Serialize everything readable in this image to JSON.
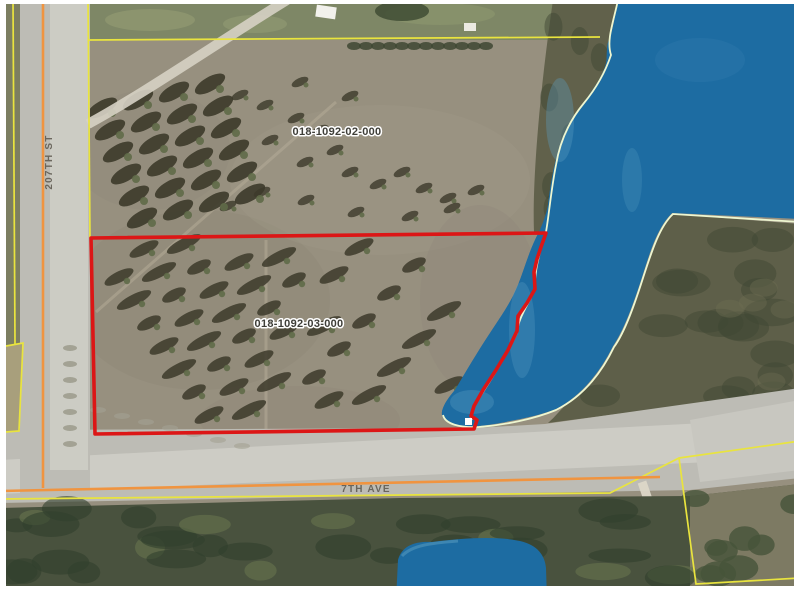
{
  "map": {
    "parcels": [
      {
        "id": "018-1092-02-000"
      },
      {
        "id": "018-1092-03-000"
      }
    ],
    "streets": [
      {
        "name": "207TH ST"
      },
      {
        "name": "7TH AVE"
      }
    ],
    "colors": {
      "water": "#1d6ca2",
      "waterLight": "#5d9fc2",
      "fieldBase": "#97907f",
      "grassTop": "#7e8766",
      "oliveStrip": "#7c7e61",
      "tanLot": "#a89f7c",
      "woods": "#5e5f49",
      "woodsDark": "#3f4734",
      "forest": "#49523e",
      "forestDark": "#313f2d",
      "forestLight": "#68754f",
      "bottomRightLot": "#7d7a63",
      "roadGray": "#bdbcb5",
      "roadLight": "#d0cfc8",
      "centerline": "#f09440",
      "parcelLine": "#e9e43e",
      "shoreline": "#eef6d0",
      "selectedParcel": "#dc1616",
      "parcelLabel": "#3e3e38",
      "streetLabel": "#5b564d",
      "treeShadow": "#3c3a2a",
      "treeCrown": "#5f6a48",
      "dirtPath": "#d6d2c4"
    }
  }
}
